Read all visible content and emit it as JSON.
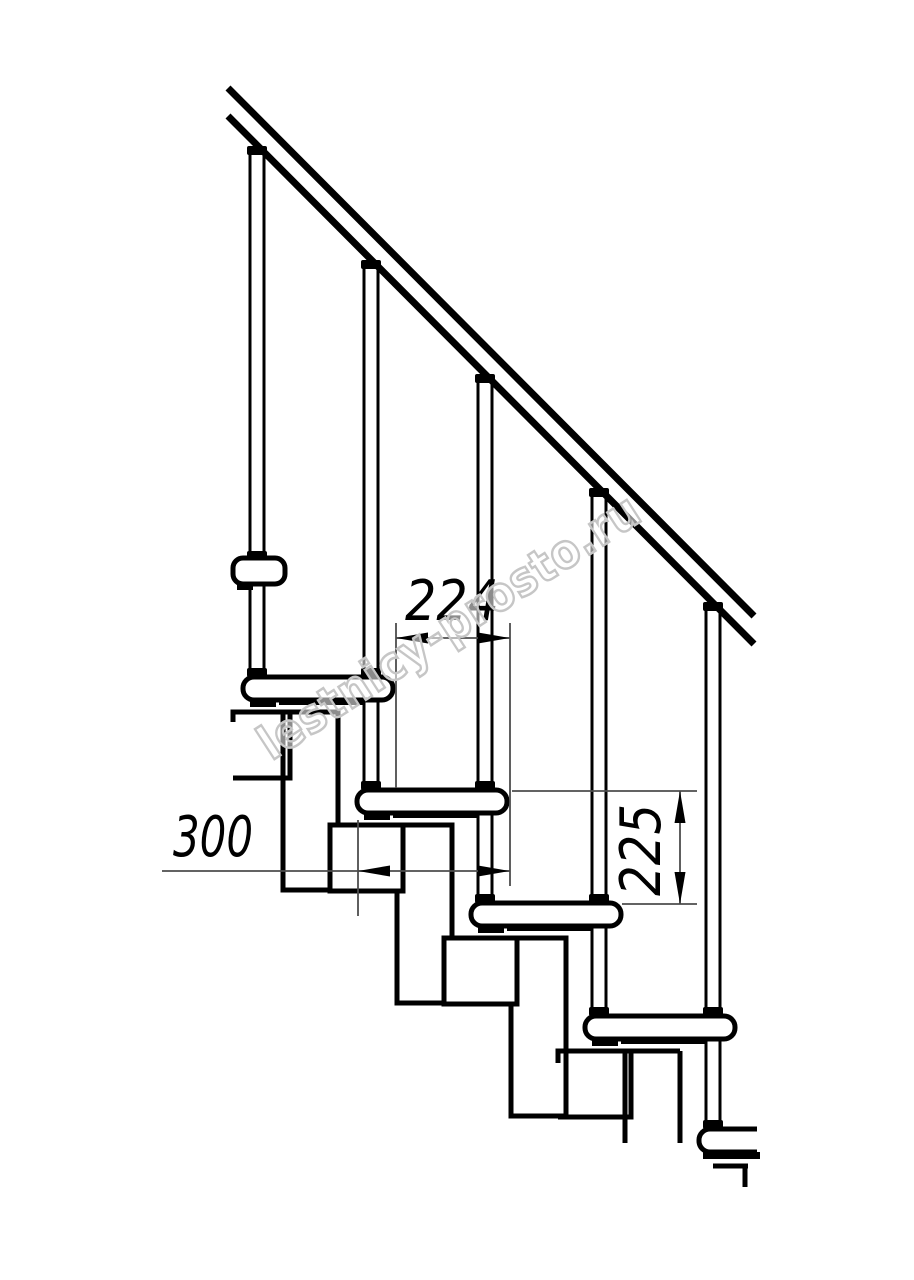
{
  "drawing": {
    "watermark": "lestnicy-prosto.ru",
    "dimensions": {
      "step_overlap_mm": "224",
      "module_depth_mm": "300",
      "riser_height_mm": "225"
    },
    "colors": {
      "ink": "#000000",
      "thin": "#4d4d4d",
      "watermark": "#c6c6c6",
      "background": "#ffffff"
    }
  }
}
